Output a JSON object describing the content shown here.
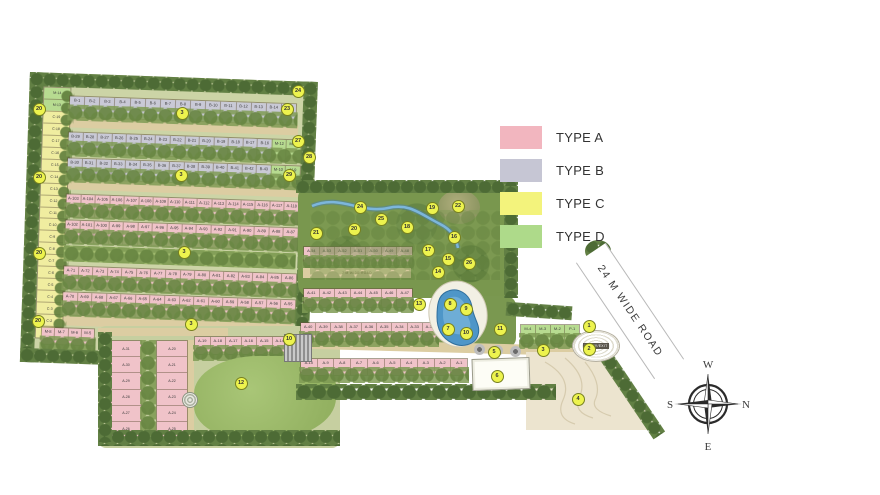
{
  "legend": {
    "items": [
      {
        "label": "TYPE A",
        "color": "#f2b6bf"
      },
      {
        "label": "TYPE B",
        "color": "#c6c6d4"
      },
      {
        "label": "TYPE C",
        "color": "#f3f37c"
      },
      {
        "label": "TYPE D",
        "color": "#aeda8a"
      }
    ]
  },
  "roads": {
    "main": "24 M WIDE ROAD",
    "internal": "7 M WIDE ROAD"
  },
  "entry": {
    "label": "ENTRY/EXIT"
  },
  "compass": {
    "top": "W",
    "right": "N",
    "bottom": "E",
    "left": "S"
  },
  "palette": {
    "tree_dark": "#4d6b35",
    "tree_light": "#7f9b54",
    "road_tan": "#dccda2",
    "water": "#4e96c8",
    "lawn": "#9cba6c",
    "marker": "#edf34e",
    "contour_area": "#ece4cf"
  },
  "plots": {
    "col_c": [
      "M-14",
      "M-13",
      "C-19",
      "C-18",
      "C-17",
      "C-16",
      "C-15",
      "C-14",
      "C-13",
      "C-12",
      "C-11",
      "C-10",
      "C-9",
      "C-8",
      "C-7",
      "C-6",
      "C-5",
      "C-4",
      "C-3",
      "C-2",
      "C-1"
    ],
    "row_b1": [
      "B-1",
      "B-2",
      "B-3",
      "B-4",
      "B-5",
      "B-6",
      "B-7",
      "B-8",
      "B-9",
      "B-10",
      "B-11",
      "B-12",
      "B-13",
      "B-14",
      "B-15"
    ],
    "row_b2": [
      "B-29",
      "B-28",
      "B-27",
      "B-26",
      "B-25",
      "B-24",
      "B-23",
      "B-22",
      "B-21",
      "B-20",
      "B-19",
      "B-18",
      "B-17",
      "B-16",
      "M-12",
      "M-11"
    ],
    "row_b3": [
      "B-30",
      "B-31",
      "B-32",
      "B-33",
      "B-34",
      "B-35",
      "B-36",
      "B-37",
      "B-38",
      "B-39",
      "B-40",
      "B-41",
      "B-42",
      "B-43",
      "M-10",
      "M-9"
    ],
    "row_a1": [
      "A-103",
      "A-104",
      "A-105",
      "A-106",
      "A-107",
      "A-108",
      "A-109",
      "A-110",
      "A-111",
      "A-112",
      "A-113",
      "A-114",
      "A-115",
      "A-116",
      "A-117",
      "A-118"
    ],
    "row_a2": [
      "A-102",
      "A-101",
      "A-100",
      "A-99",
      "A-98",
      "A-97",
      "A-96",
      "A-95",
      "A-94",
      "A-93",
      "A-92",
      "A-91",
      "A-90",
      "A-89",
      "A-88",
      "A-87"
    ],
    "row_a3": [
      "A-71",
      "A-72",
      "A-73",
      "A-74",
      "A-75",
      "A-76",
      "A-77",
      "A-78",
      "A-79",
      "A-80",
      "A-81",
      "A-82",
      "A-83",
      "A-84",
      "A-85",
      "A-86"
    ],
    "row_a4": [
      "A-70",
      "A-69",
      "A-68",
      "A-67",
      "A-66",
      "A-65",
      "A-64",
      "A-63",
      "A-62",
      "A-61",
      "A-60",
      "A-59",
      "A-58",
      "A-57",
      "A-56",
      "A-55"
    ],
    "row_m": [
      "M-8",
      "M-7",
      "M-6",
      "M-5"
    ],
    "row_a5": [
      "A-19",
      "A-18",
      "A-17",
      "A-16",
      "A-15",
      "A-14"
    ],
    "row_a6": [
      "A-13",
      "A-12",
      "A-11"
    ],
    "col_left": [
      "A-31",
      "A-30",
      "A-29",
      "A-28",
      "A-27",
      "A-26"
    ],
    "col_right": [
      "A-20",
      "A-21",
      "A-22",
      "A-23",
      "A-24",
      "A-25"
    ],
    "row_a7": [
      "A-54",
      "A-53",
      "A-52",
      "A-51",
      "A-50",
      "A-49",
      "A-48"
    ],
    "row_a8": [
      "A-41",
      "A-42",
      "A-43",
      "A-44",
      "A-45",
      "A-46",
      "A-47"
    ],
    "row_a9": [
      "A-40",
      "A-39",
      "A-38",
      "A-37",
      "A-36",
      "A-35",
      "A-34",
      "A-33",
      "A-32"
    ],
    "row_a10": [
      "A-10",
      "A-9",
      "A-8",
      "A-7",
      "A-6",
      "A-5",
      "A-4",
      "A-3",
      "A-2",
      "A-1"
    ],
    "row_p": [
      "M-4",
      "M-3",
      "M-2",
      "P-1"
    ]
  },
  "markers": [
    {
      "n": "20",
      "x": 38,
      "y": 108
    },
    {
      "n": "20",
      "x": 38,
      "y": 176
    },
    {
      "n": "20",
      "x": 38,
      "y": 252
    },
    {
      "n": "20",
      "x": 37,
      "y": 320
    },
    {
      "n": "24",
      "x": 297,
      "y": 90
    },
    {
      "n": "23",
      "x": 286,
      "y": 108
    },
    {
      "n": "27",
      "x": 297,
      "y": 140
    },
    {
      "n": "28",
      "x": 308,
      "y": 156
    },
    {
      "n": "29",
      "x": 288,
      "y": 174
    },
    {
      "n": "3",
      "x": 181,
      "y": 112
    },
    {
      "n": "3",
      "x": 180,
      "y": 174
    },
    {
      "n": "3",
      "x": 183,
      "y": 251
    },
    {
      "n": "3",
      "x": 190,
      "y": 323
    },
    {
      "n": "3",
      "x": 542,
      "y": 349
    },
    {
      "n": "24",
      "x": 359,
      "y": 206
    },
    {
      "n": "25",
      "x": 380,
      "y": 218
    },
    {
      "n": "21",
      "x": 315,
      "y": 232
    },
    {
      "n": "20",
      "x": 353,
      "y": 228
    },
    {
      "n": "19",
      "x": 431,
      "y": 207
    },
    {
      "n": "22",
      "x": 457,
      "y": 205
    },
    {
      "n": "18",
      "x": 406,
      "y": 226
    },
    {
      "n": "16",
      "x": 453,
      "y": 236
    },
    {
      "n": "17",
      "x": 427,
      "y": 249
    },
    {
      "n": "15",
      "x": 447,
      "y": 258
    },
    {
      "n": "26",
      "x": 468,
      "y": 262
    },
    {
      "n": "14",
      "x": 437,
      "y": 271
    },
    {
      "n": "13",
      "x": 418,
      "y": 303
    },
    {
      "n": "8",
      "x": 449,
      "y": 303
    },
    {
      "n": "9",
      "x": 465,
      "y": 308
    },
    {
      "n": "7",
      "x": 447,
      "y": 328
    },
    {
      "n": "10",
      "x": 465,
      "y": 332
    },
    {
      "n": "11",
      "x": 499,
      "y": 328
    },
    {
      "n": "5",
      "x": 493,
      "y": 351
    },
    {
      "n": "6",
      "x": 496,
      "y": 375
    },
    {
      "n": "12",
      "x": 240,
      "y": 382
    },
    {
      "n": "10",
      "x": 288,
      "y": 338
    },
    {
      "n": "1",
      "x": 588,
      "y": 325
    },
    {
      "n": "2",
      "x": 588,
      "y": 348
    },
    {
      "n": "4",
      "x": 577,
      "y": 398
    }
  ]
}
